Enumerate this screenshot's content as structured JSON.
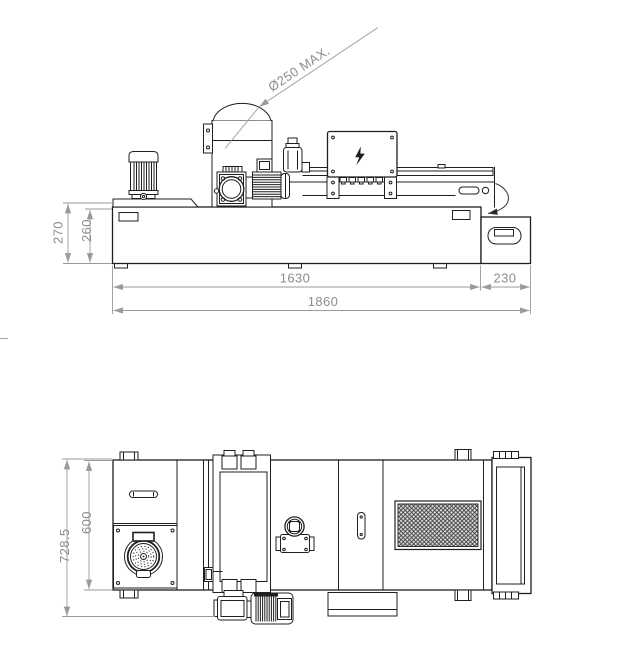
{
  "canvas": {
    "background": "#ffffff",
    "line_color": "#1f1f1f",
    "dimension_line_color": "#9a9a9a",
    "dimension_text_color": "#8d8d8d",
    "grille_fill": "#dcdcdc"
  },
  "side_view": {
    "dims": {
      "overall_height": "270",
      "tank_height": "260",
      "tank_length": "1630",
      "extension_length": "230",
      "overall_length": "1860",
      "max_diameter": "Ø250 MAX."
    }
  },
  "plan_view": {
    "dims": {
      "overall_width": "728.5",
      "body_width": "600"
    }
  }
}
